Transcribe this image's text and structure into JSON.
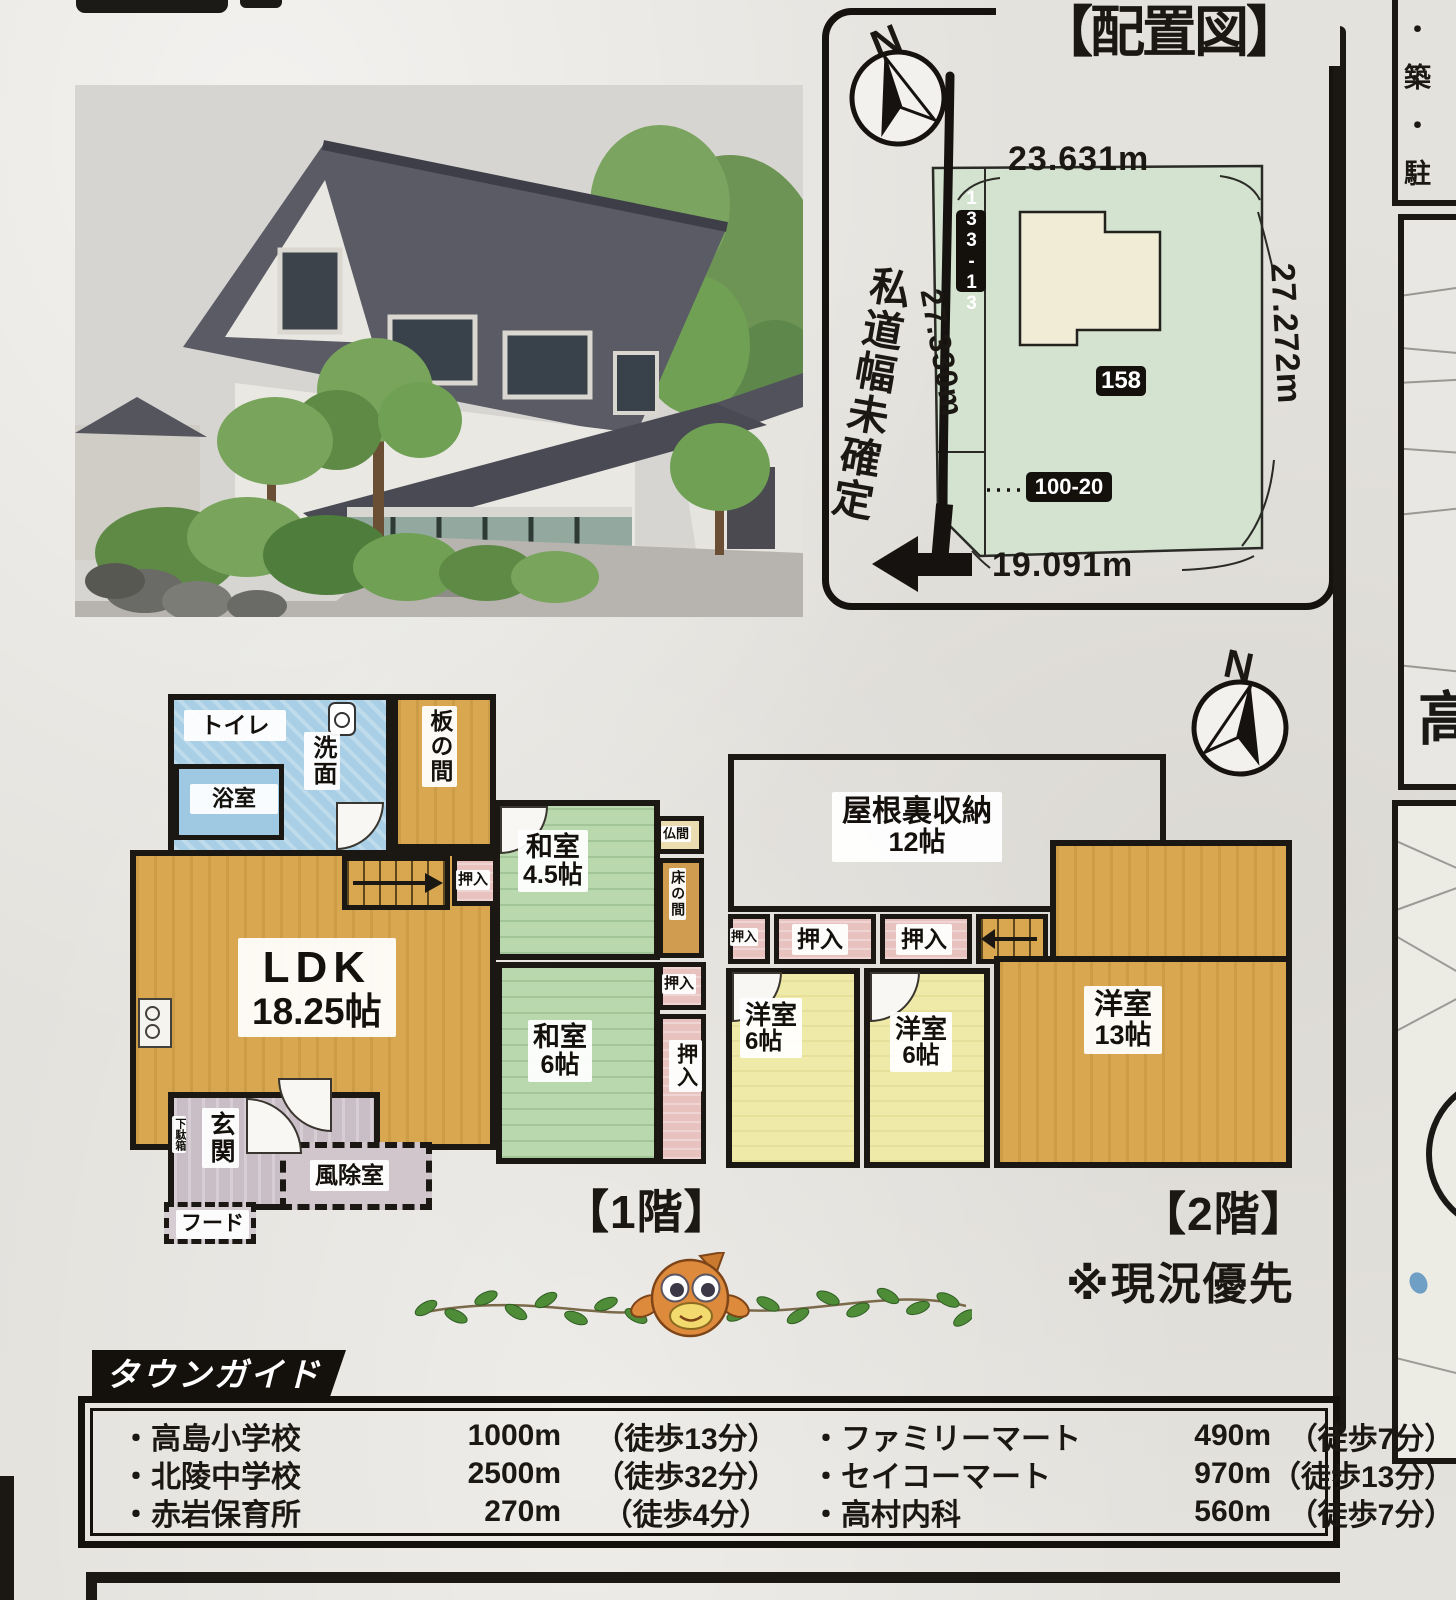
{
  "compass_n": "N",
  "site_plan": {
    "title": "【配置図】",
    "road_label": "私道幅未確定",
    "dim_top": "23.631m",
    "dim_right": "27.272m",
    "dim_left": "27.330m",
    "dim_bottom": "19.091m",
    "parcel_strip": "133-13",
    "parcel_main": "158",
    "parcel_lower": "100-20"
  },
  "floor1": {
    "label": "【1階】",
    "toilet": "トイレ",
    "bath": "浴室",
    "washroom": "洗面",
    "itanoma": "板の間",
    "washitsu45_name": "和室",
    "washitsu45_size": "4.5帖",
    "butsuma": "仏間",
    "tokonoma": "床の間",
    "washitsu6_name": "和室",
    "washitsu6_size": "6帖",
    "ldk_name": "LDK",
    "ldk_size": "18.25帖",
    "oshiire": "押入",
    "genkan": "玄関",
    "getabako": "下駄箱",
    "windbreak": "風除室",
    "hood": "フード"
  },
  "floor2": {
    "label": "【2階】",
    "note": "※現況優先",
    "attic_name": "屋根裏収納",
    "attic_size": "12帖",
    "oshiire": "押入",
    "yoshitsu6_name": "洋室",
    "yoshitsu6_size": "6帖",
    "yoshitsu13_name": "洋室",
    "yoshitsu13_size": "13帖"
  },
  "right_column": {
    "list_items": [
      "・築",
      "・駐",
      "・土",
      "行"
    ],
    "map_char": "高"
  },
  "town_guide": {
    "title": "タウンガイド",
    "left": [
      {
        "name": "・高島小学校",
        "distance": "1000m",
        "walk": "（徒歩13分）"
      },
      {
        "name": "・北陵中学校",
        "distance": "2500m",
        "walk": "（徒歩32分）"
      },
      {
        "name": "・赤岩保育所",
        "distance": "270m",
        "walk": "（徒歩4分）"
      }
    ],
    "right": [
      {
        "name": "・ファミリーマート",
        "distance": "490m",
        "walk": "（徒歩7分）"
      },
      {
        "name": "・セイコーマート",
        "distance": "970m",
        "walk": "（徒歩13分）"
      },
      {
        "name": "・高村内科",
        "distance": "560m",
        "walk": "（徒歩7分）"
      }
    ]
  },
  "colors": {
    "paper": "#e4e2dd",
    "wall_black": "#1b1814",
    "wood_tan": "#d8a74f",
    "tatami_green": "#b9d8ad",
    "wet_blue": "#a9cfe6",
    "closet_pink": "#e7c2be",
    "pale_yellow": "#f0eaa8",
    "attic_pink": "#f2e2e2",
    "entry_gray": "#c9bec5",
    "parcel_green": "#d3e3cf",
    "footprint_cream": "#f1ecd6",
    "fish_orange": "#dd8a3c",
    "leaf_green": "#4e8c38"
  }
}
